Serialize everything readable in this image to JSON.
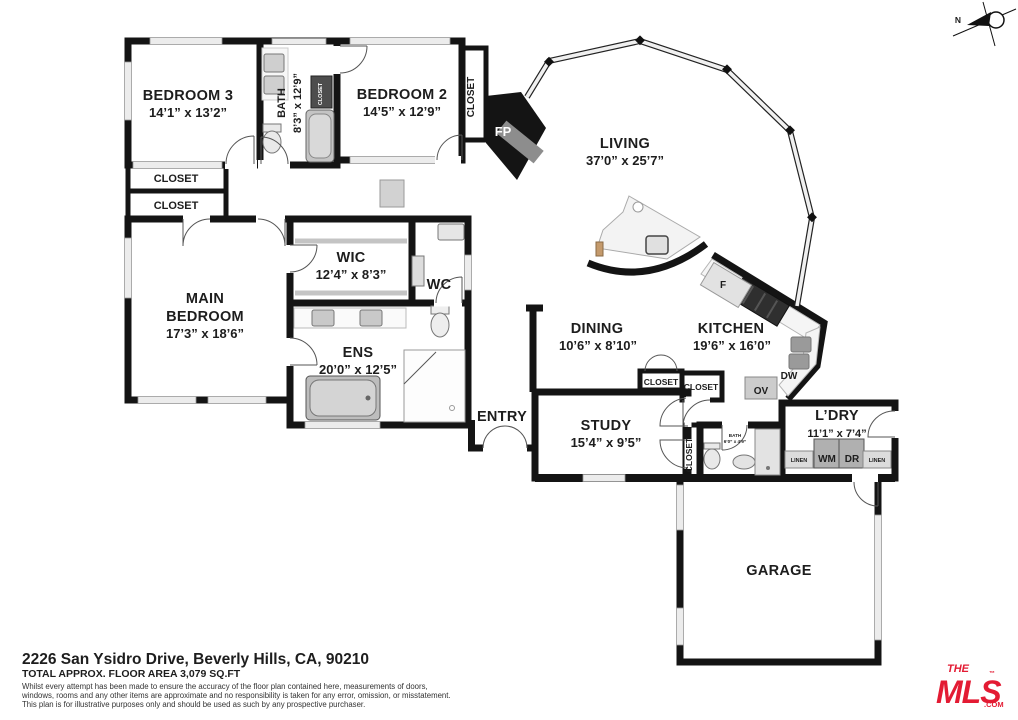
{
  "plan": {
    "bedroom3": {
      "name": "BEDROOM 3",
      "dims": "14’1” x 13’2”"
    },
    "bath": {
      "name": "BATH",
      "dims": "8’3” x 12’9”"
    },
    "bedroom2": {
      "name": "BEDROOM 2",
      "dims": "14’5” x 12’9”"
    },
    "main_bedroom": {
      "line1": "MAIN",
      "line2": "BEDROOM",
      "dims": "17’3” x 18’6”"
    },
    "wic": {
      "name": "WIC",
      "dims": "12’4” x 8’3”"
    },
    "wc": {
      "name": "WC"
    },
    "ens": {
      "name": "ENS",
      "dims": "20’0” x 12’5”"
    },
    "living": {
      "name": "LIVING",
      "dims": "37’0” x 25’7”"
    },
    "dining": {
      "name": "DINING",
      "dims": "10’6” x 8’10”"
    },
    "kitchen": {
      "name": "KITCHEN",
      "dims": "19’6” x 16’0”"
    },
    "entry": {
      "name": "ENTRY"
    },
    "study": {
      "name": "STUDY",
      "dims": "15’4” x 9’5”"
    },
    "small_bath": {
      "name": "BATH",
      "dims": "6’0” x 4’9”"
    },
    "laundry": {
      "name": "L’DRY",
      "dims": "11’1” x 7’4”"
    },
    "garage": {
      "name": "GARAGE"
    },
    "labels": {
      "closet": "CLOSET",
      "fp": "FP",
      "fridge": "F",
      "dishwasher": "DW",
      "oven": "OV",
      "washer": "WM",
      "dryer": "DR",
      "linen": "LINEN",
      "north": "N"
    }
  },
  "footer": {
    "address": "2226 San Ysidro Drive, Beverly Hills, CA, 90210",
    "area": "TOTAL APPROX. FLOOR AREA 3,079 SQ.FT",
    "disclaimer1": "Whilst every attempt has been made to ensure the accuracy of the floor plan contained here, measurements of doors,",
    "disclaimer2": "windows, rooms and any other items are approximate and no responsibility is taken for any error, omission, or misstatement.",
    "disclaimer3": "This plan is for illustrative purposes only and should be used as such by any prospective purchaser."
  },
  "logo": {
    "the": "THE",
    "mls": "MLS",
    "com": ".COM",
    "tm": "™"
  },
  "colors": {
    "wall": "#141414",
    "water_room": "#c3e2f4",
    "logo_red": "#e31b33"
  }
}
